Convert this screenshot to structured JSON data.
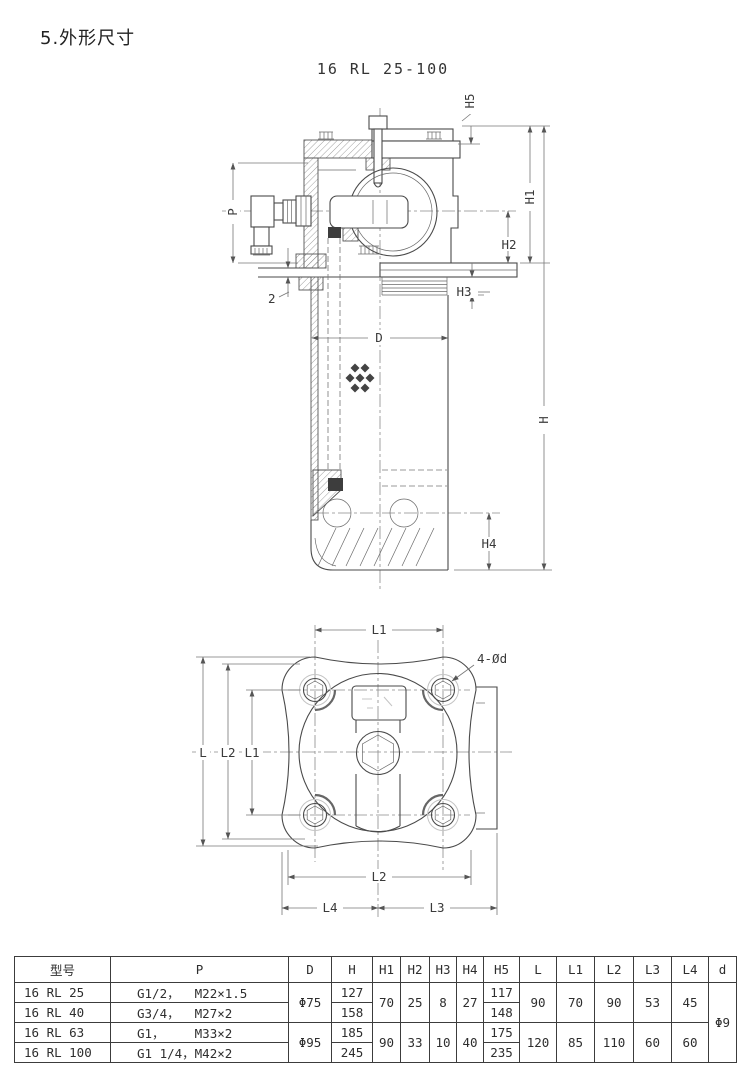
{
  "page": {
    "section_title": "5.外形尺寸",
    "figure_title": "16 RL 25-100"
  },
  "side_view": {
    "dim_labels": {
      "h5": "H5",
      "h1": "H1",
      "h2": "H2",
      "h3": "H3",
      "h4": "H4",
      "h": "H",
      "p": "P",
      "d": "D",
      "plate": "2"
    }
  },
  "bottom_view": {
    "dim_labels": {
      "l1_top": "L1",
      "holes": "4-Ød",
      "l": "L",
      "l2": "L2",
      "l1": "L1",
      "l2_bottom": "L2",
      "l4": "L4",
      "l3": "L3"
    }
  },
  "table": {
    "headers": [
      "型号",
      "P",
      "D",
      "H",
      "H1",
      "H2",
      "H3",
      "H4",
      "H5",
      "L",
      "L1",
      "L2",
      "L3",
      "L4",
      "d"
    ],
    "rows": [
      {
        "model": "16 RL 25",
        "p": "G1/2，  M22×1.5",
        "h": "127",
        "h5": "117"
      },
      {
        "model": "16 RL 40",
        "p": "G3/4，  M27×2",
        "h": "158",
        "h5": "148"
      },
      {
        "model": "16 RL 63",
        "p": "G1，    M33×2",
        "h": "185",
        "h5": "175"
      },
      {
        "model": "16 RL 100",
        "p": "G1 1/4，M42×2",
        "h": "245",
        "h5": "235"
      }
    ],
    "groups": [
      {
        "d": "Φ75",
        "h1": "70",
        "h2": "25",
        "h3": "8",
        "h4": "27",
        "l": "90",
        "l1": "70",
        "l2": "90",
        "l3": "53",
        "l4": "45"
      },
      {
        "d": "Φ95",
        "h1": "90",
        "h2": "33",
        "h3": "10",
        "h4": "40",
        "l": "120",
        "l1": "85",
        "l2": "110",
        "l3": "60",
        "l4": "60"
      }
    ],
    "d_hole": "Φ9"
  }
}
